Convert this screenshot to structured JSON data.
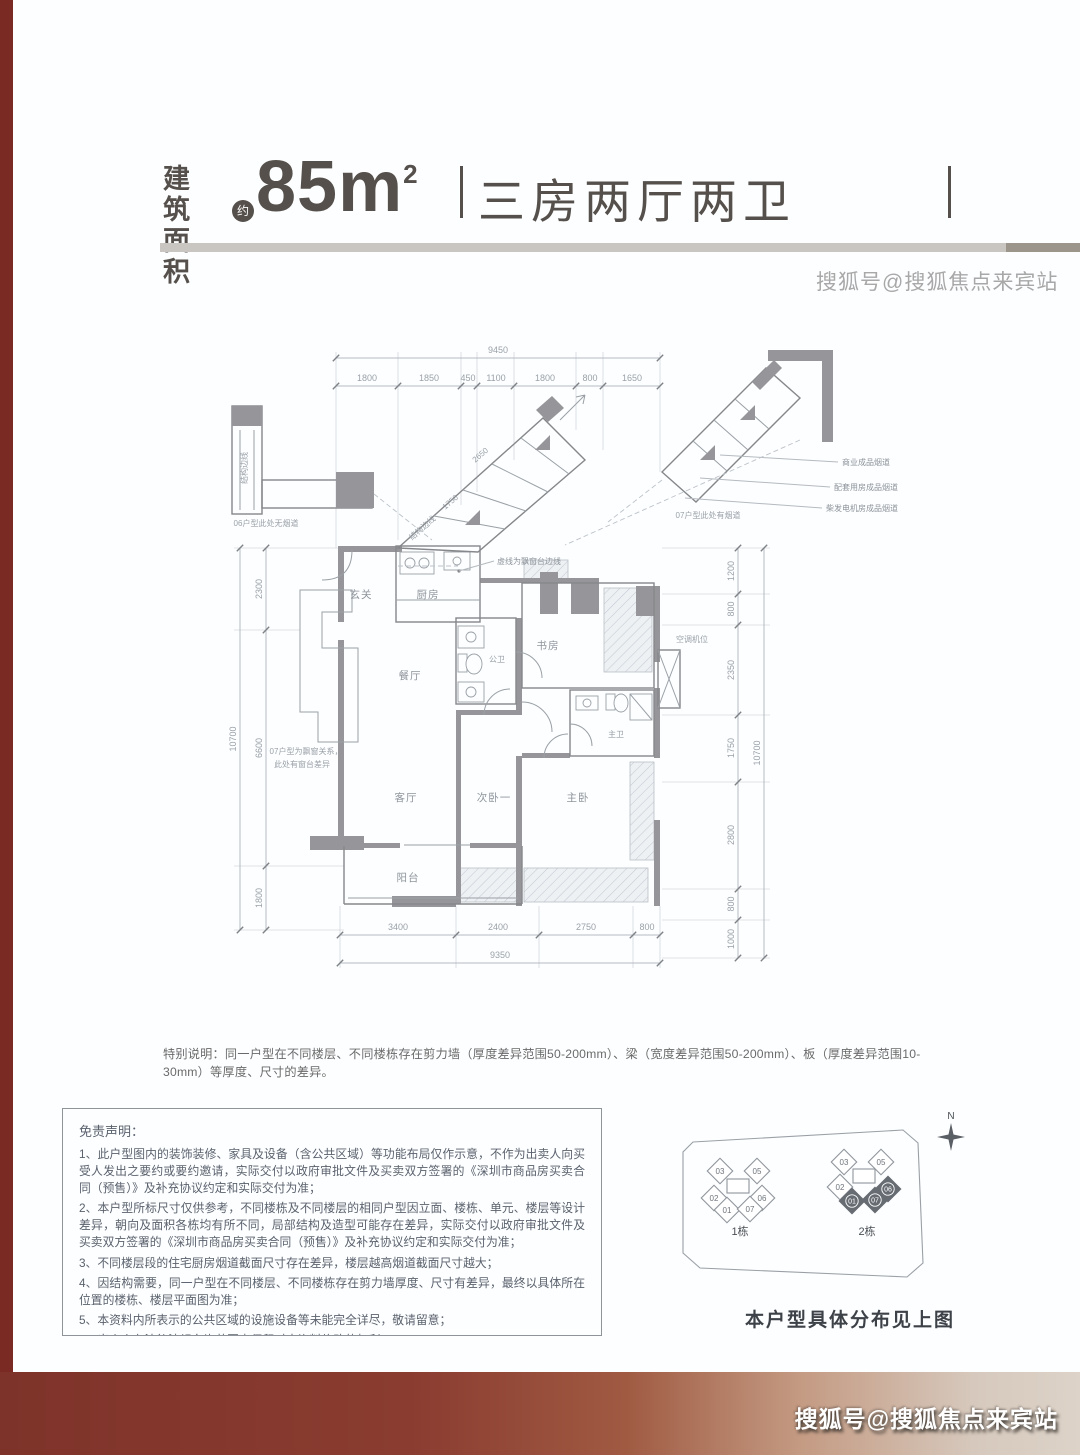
{
  "header": {
    "area_label_line1": "建筑",
    "area_label_line2": "面积",
    "approx_badge": "约",
    "area_value": "85m",
    "area_superscript": "2",
    "layout_text": "三房两厅两卫"
  },
  "watermarks": {
    "top_right": "搜狐号@搜狐焦点来宾站",
    "bottom_right": "搜狐号@搜狐焦点来宾站"
  },
  "floor_plan": {
    "dims": {
      "top_total": "9450",
      "top_segments": [
        "1800",
        "1850",
        "450",
        "1100",
        "1800",
        "800",
        "1650"
      ],
      "left_total": "10700",
      "left_segments": [
        "2300",
        "6600",
        "1800"
      ],
      "right_total": "10700",
      "right_segments": [
        "1200",
        "800",
        "2350",
        "1750",
        "2800",
        "800",
        "1000"
      ],
      "bottom_segments": [
        "3400",
        "2400",
        "2750",
        "800"
      ],
      "bottom_total": "9350",
      "diag_upper": "2650",
      "diag_lower": "1750"
    },
    "rooms": {
      "entry": "玄关",
      "kitchen": "厨房",
      "dining": "餐厅",
      "living": "客厅",
      "balcony": "阳台",
      "bedroom2": "次卧一",
      "master_bedroom": "主卧",
      "study": "书房",
      "public_bath": "公卫",
      "master_bath": "主卫",
      "ac_platform": "空调机位"
    },
    "notes": {
      "bay_edge": "虚线为飘窗台边线",
      "flue_commercial": "商业成品烟道",
      "flue_ancillary": "配套用房成品烟道",
      "flue_generator": "柴发电机房成品烟道",
      "unit07_flue": "07户型此处有烟道",
      "unit06_no_flue": "06户型此处无烟道",
      "structure_edge": "结构边线",
      "unit07_bay_1": "07户型为飘窗关系，",
      "unit07_bay_2": "此处有窗台差异"
    }
  },
  "special_note": "特别说明：同一户型在不同楼层、不同楼栋存在剪力墙（厚度差异范围50-200mm）、梁（宽度差异范围50-200mm）、板（厚度差异范围10-30mm）等厚度、尺寸的差异。",
  "disclaimer": {
    "title": "免责声明：",
    "items": [
      "1、此户型图内的装饰装修、家具及设备（含公共区域）等功能布局仅作示意，不作为出卖人向买受人发出之要约或要约邀请，实际交付以政府审批文件及买卖双方签署的《深圳市商品房买卖合同（预售）》及补充协议约定和实际交付为准；",
      "2、本户型所标尺寸仅供参考，不同楼栋及不同楼层的相同户型因立面、楼栋、单元、楼层等设计差异，朝向及面积各栋均有所不同，局部结构及造型可能存在差异，实际交付以政府审批文件及买卖双方签署的《深圳市商品房买卖合同（预售）》及补充协议约定和实际交付为准；",
      "3、不同楼层段的住宅厨房烟道截面尺寸存在差异，楼层越高烟道截面尺寸越大；",
      "4、因结构需要，同一户型在不同楼层、不同楼栋存在剪力墙厚度、尺寸有差异，最终以具体所在位置的楼栋、楼层平面图为准；",
      "5、本资料内所表示的公共区域的设施设备等未能完全详尽，敬请留意；",
      "6、出卖人在法律法规允许范围内保留对本资料修改的权利；",
      "7、本资料制作时间：2024年7月。"
    ]
  },
  "site_plan": {
    "north": "N",
    "b1_label": "1栋",
    "b2_label": "2栋",
    "b1_units": {
      "u03": "03",
      "u05": "05",
      "u02": "02",
      "u06": "06",
      "u01": "01",
      "u07": "07"
    },
    "b2_units": {
      "u03": "03",
      "u05": "05",
      "u02": "02",
      "u06": "06",
      "u01": "01",
      "u07": "07"
    },
    "caption": "本户型具体分布见上图"
  }
}
